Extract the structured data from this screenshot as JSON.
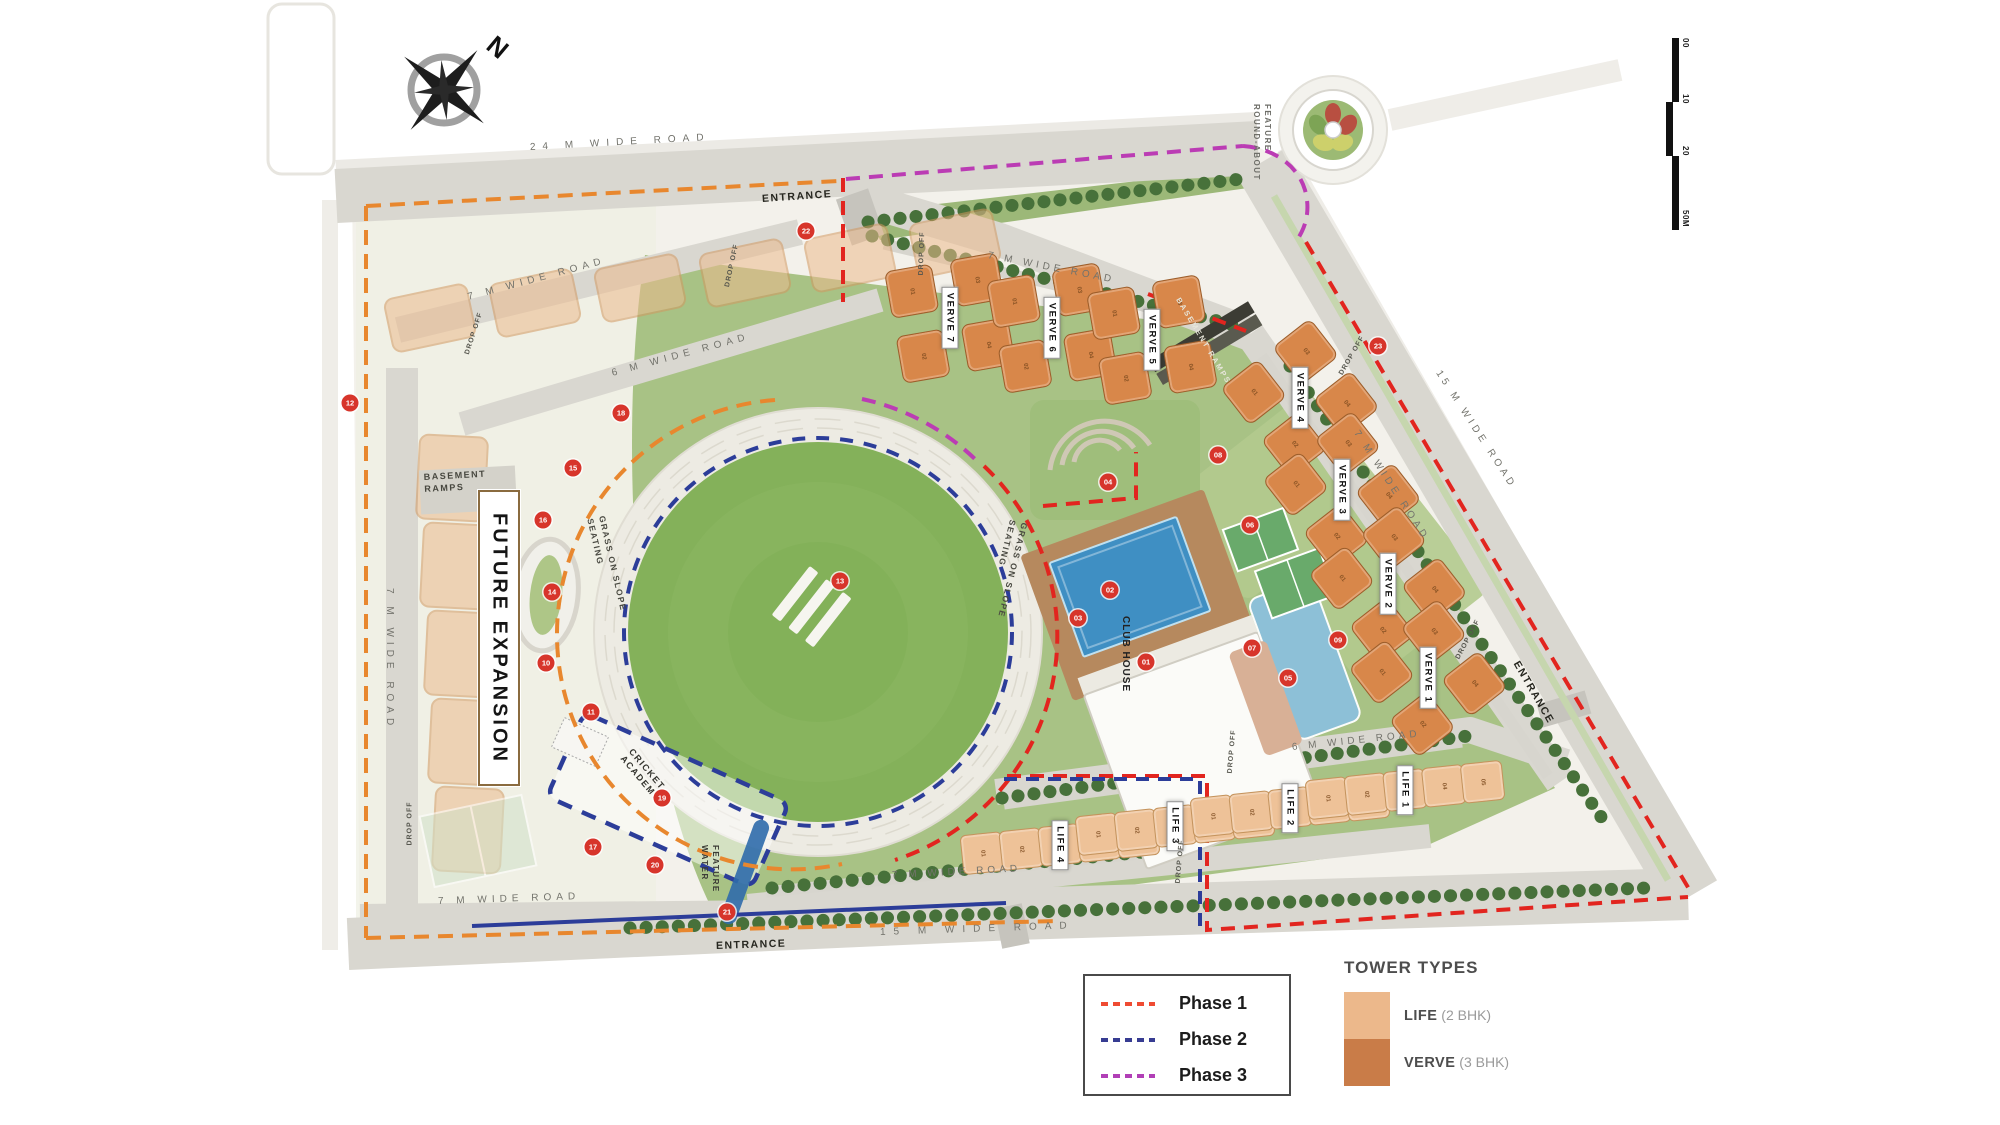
{
  "map": {
    "compass_n": "N",
    "scale_ticks": [
      "00",
      "10",
      "20",
      "50M"
    ],
    "roads": {
      "top": "24 M WIDE ROAD",
      "future_top": "7 M WIDE ROAD",
      "future_mid": "6 M WIDE ROAD",
      "future_left": "7 M WIDE ROAD",
      "future_bottom": "7 M WIDE ROAD",
      "inner_top": "7 M WIDE ROAD",
      "inner_right": "7 M WIDE ROAD",
      "life_top": "6 M WIDE ROAD",
      "inner_bottom": "7 M WIDE ROAD",
      "bottom": "15 M WIDE ROAD",
      "outer_right": "15 M WIDE ROAD"
    },
    "entrance": "ENTRANCE",
    "labels": {
      "future_expansion": "FUTURE EXPANSION",
      "basement_ramps": "BASEMENT RAMPS",
      "roundabout_line1": "ROUND-ABOUT",
      "roundabout_line2": "FEATURE",
      "seating_line1": "SEATING",
      "seating_line2": "GRASS ON SLOPE",
      "cricket_academy_line1": "CRICKET",
      "cricket_academy_line2": "ACADEMY",
      "water_line1": "WATER",
      "water_line2": "FEATURE",
      "club_house": "CLUB HOUSE",
      "drop_off": "DROP OFF"
    },
    "towers": [
      {
        "name": "VERVE 7",
        "type": "verve",
        "x": 950,
        "y": 318,
        "a": -10,
        "units": [
          "01",
          "02",
          "03",
          "04"
        ]
      },
      {
        "name": "VERVE 6",
        "type": "verve",
        "x": 1052,
        "y": 328,
        "a": -10,
        "units": [
          "01",
          "02",
          "03",
          "04"
        ]
      },
      {
        "name": "VERVE 5",
        "type": "verve",
        "x": 1152,
        "y": 340,
        "a": -10,
        "units": [
          "01",
          "02",
          "03",
          "04"
        ]
      },
      {
        "name": "VERVE 4",
        "type": "verve",
        "x": 1300,
        "y": 398,
        "a": -38,
        "units": [
          "01",
          "02",
          "03",
          "04"
        ]
      },
      {
        "name": "VERVE 3",
        "type": "verve",
        "x": 1342,
        "y": 490,
        "a": -38,
        "units": [
          "01",
          "02",
          "03",
          "04"
        ]
      },
      {
        "name": "VERVE 2",
        "type": "verve",
        "x": 1388,
        "y": 584,
        "a": -38,
        "units": [
          "01",
          "02",
          "03",
          "04"
        ]
      },
      {
        "name": "VERVE 1",
        "type": "verve",
        "x": 1428,
        "y": 678,
        "a": -38,
        "units": [
          "01",
          "02",
          "03",
          "04"
        ]
      },
      {
        "name": "LIFE 4",
        "type": "life",
        "x": 1060,
        "y": 845,
        "a": -6,
        "units": [
          "01",
          "02",
          "03",
          "04",
          "05"
        ]
      },
      {
        "name": "LIFE 3",
        "type": "life",
        "x": 1175,
        "y": 826,
        "a": -6,
        "units": [
          "01",
          "02",
          "03",
          "04",
          "05"
        ]
      },
      {
        "name": "LIFE 2",
        "type": "life",
        "x": 1290,
        "y": 808,
        "a": -6,
        "units": [
          "01",
          "02",
          "03",
          "04",
          "05"
        ]
      },
      {
        "name": "LIFE 1",
        "type": "life",
        "x": 1405,
        "y": 790,
        "a": -6,
        "units": [
          "01",
          "02",
          "03",
          "04",
          "05"
        ]
      }
    ],
    "markers": [
      {
        "n": "12",
        "x": 350,
        "y": 403
      },
      {
        "n": "22",
        "x": 806,
        "y": 231
      },
      {
        "n": "18",
        "x": 621,
        "y": 413
      },
      {
        "n": "15",
        "x": 573,
        "y": 468
      },
      {
        "n": "16",
        "x": 543,
        "y": 520
      },
      {
        "n": "14",
        "x": 552,
        "y": 592
      },
      {
        "n": "10",
        "x": 546,
        "y": 663
      },
      {
        "n": "11",
        "x": 591,
        "y": 712
      },
      {
        "n": "19",
        "x": 662,
        "y": 798
      },
      {
        "n": "20",
        "x": 655,
        "y": 865
      },
      {
        "n": "21",
        "x": 727,
        "y": 912
      },
      {
        "n": "17",
        "x": 593,
        "y": 847
      },
      {
        "n": "13",
        "x": 840,
        "y": 581
      },
      {
        "n": "23",
        "x": 1378,
        "y": 346
      },
      {
        "n": "04",
        "x": 1108,
        "y": 482
      },
      {
        "n": "08",
        "x": 1218,
        "y": 455
      },
      {
        "n": "06",
        "x": 1250,
        "y": 525
      },
      {
        "n": "02",
        "x": 1110,
        "y": 590
      },
      {
        "n": "03",
        "x": 1078,
        "y": 618
      },
      {
        "n": "01",
        "x": 1146,
        "y": 662
      },
      {
        "n": "07",
        "x": 1252,
        "y": 648
      },
      {
        "n": "05",
        "x": 1288,
        "y": 678
      },
      {
        "n": "09",
        "x": 1338,
        "y": 640
      }
    ]
  },
  "legend": {
    "phases": [
      {
        "label": "Phase 1",
        "color": "#EF4B32"
      },
      {
        "label": "Phase 2",
        "color": "#373C92"
      },
      {
        "label": "Phase 3",
        "color": "#B13FB6"
      }
    ],
    "tower_types": {
      "title": "TOWER TYPES",
      "items": [
        {
          "name": "LIFE",
          "spec": " (2 BHK)",
          "color": "#ECB88B"
        },
        {
          "name": "VERVE",
          "spec": " (3 BHK)",
          "color": "#C97C48"
        }
      ]
    }
  }
}
